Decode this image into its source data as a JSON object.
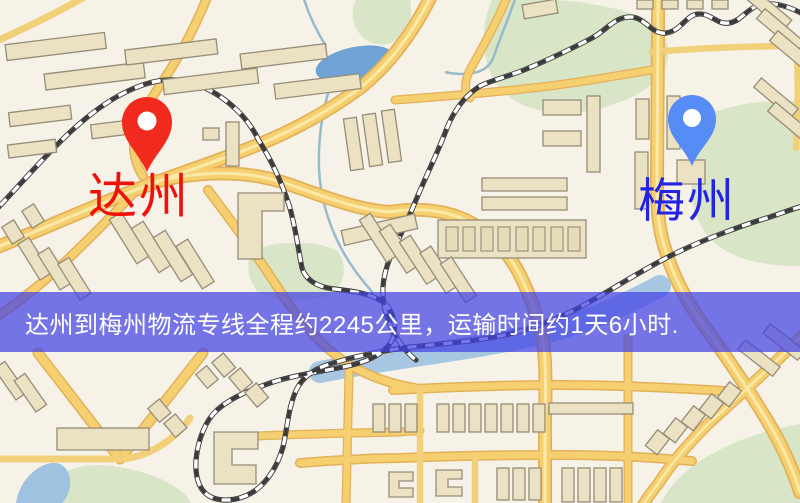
{
  "banner": {
    "text": "达州到梅州物流专线全程约2245公里，运输时间约1天6小时.",
    "distance_km": "2245",
    "transit_time": "1天6小时",
    "background_color": "#4242E4",
    "text_color": "#FFFFFF"
  },
  "markers": {
    "origin": {
      "label": "达州",
      "pin_color": "#F2291D",
      "label_color": "#EF120C"
    },
    "destination": {
      "label": "梅州",
      "pin_color": "#558CF5",
      "label_color": "#2323E6"
    }
  },
  "map_colors": {
    "background": "#F6F2E8",
    "road": "#F5CF70",
    "road_edge": "#E2B158",
    "building": "#EBE2C3",
    "building_outline": "#968C78",
    "green_area": "#D8E5C6",
    "water": "#6FA3D6",
    "river": "#A6C6E2",
    "railway": "#3A3A3A"
  }
}
